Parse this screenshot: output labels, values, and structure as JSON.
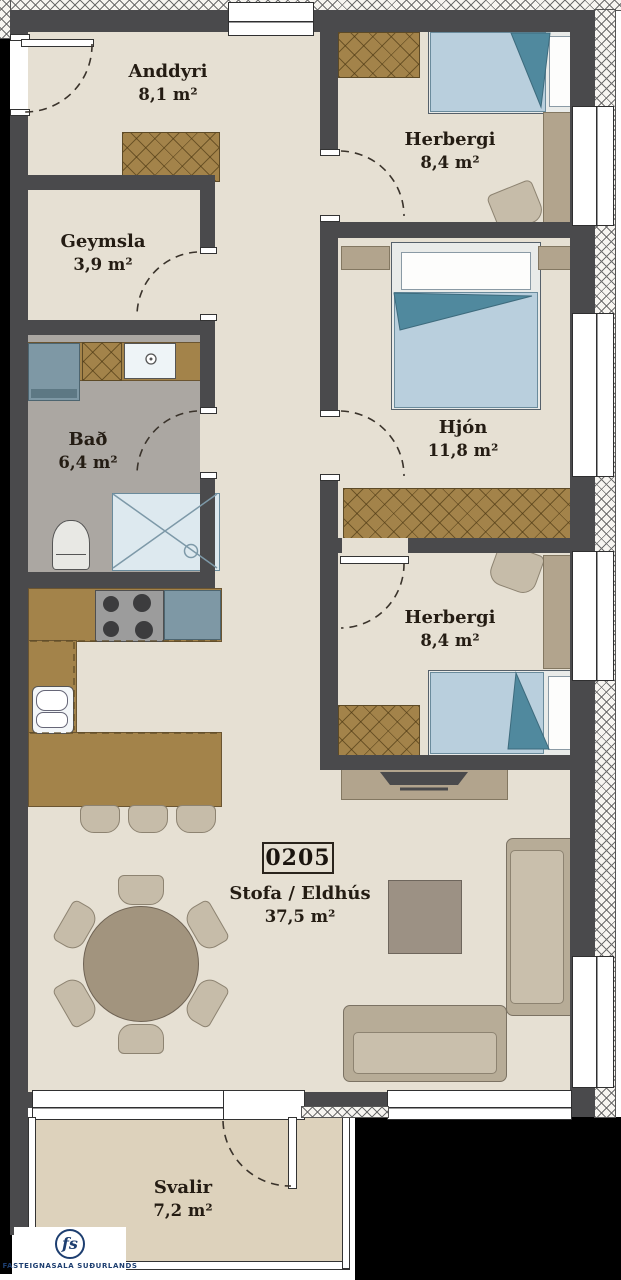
{
  "unit_label": "0205",
  "rooms": [
    {
      "name": "Anddyri",
      "area": "8,1 m²"
    },
    {
      "name": "Herbergi",
      "area": "8,4 m²"
    },
    {
      "name": "Geymsla",
      "area": "3,9 m²"
    },
    {
      "name": "Bað",
      "area": "6,4 m²"
    },
    {
      "name": "Hjón",
      "area": "11,8 m²"
    },
    {
      "name": "Herbergi",
      "area": "8,4 m²"
    },
    {
      "name": "Stofa / Eldhús",
      "area": "37,5 m²"
    },
    {
      "name": "Svalir",
      "area": "7,2 m²"
    }
  ],
  "logo": {
    "monogram": "fs",
    "text": "FASTEIGNASALA SUÐURLANDS"
  },
  "colors": {
    "wall": "#4a4a4c",
    "floor": "#e6e0d3",
    "bath_floor": "#aba7a2",
    "balcony_floor": "#ddd2bc",
    "cabinet_wood": "#a3834a",
    "furniture_tan": "#b2a48d",
    "sofa": "#b7ac97",
    "bed_blanket": "#b9cfdd",
    "bed_fold": "#50899e",
    "appliance": "#7e98a5",
    "logo_navy": "#1d3e70",
    "text": "#241c13"
  }
}
